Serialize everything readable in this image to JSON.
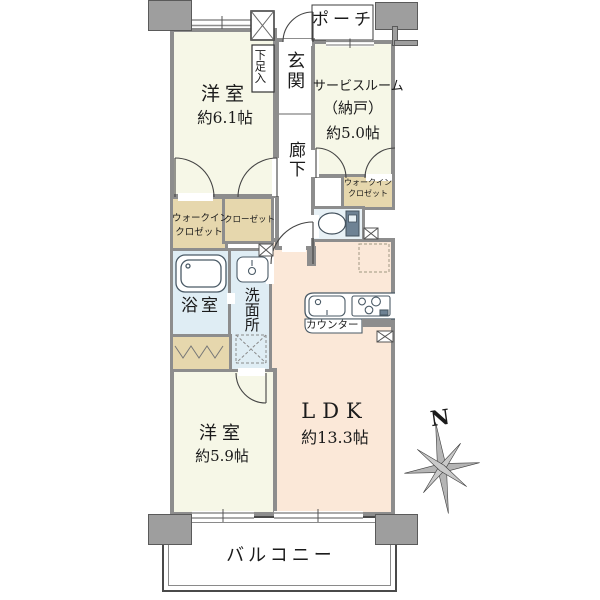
{
  "plan": {
    "rooms": {
      "porch": "ポーチ",
      "entrance": "玄関",
      "shoe_cabinet": "下足入",
      "hallway": "廊下",
      "bedroom1": {
        "name": "洋室",
        "size": "約6.1帖"
      },
      "service_room": {
        "name": "サービスルーム",
        "sub": "（納戸）",
        "size": "約5.0帖"
      },
      "wic_right": {
        "line1": "ウォークイン",
        "line2": "クロゼット"
      },
      "wic_left": {
        "line1": "ウォークイン",
        "line2": "クロゼット"
      },
      "closet": "クローゼット",
      "bathroom": "浴室",
      "washroom": "洗面所",
      "counter": "カウンター",
      "ldk": {
        "name": "LDK",
        "size": "約13.3帖"
      },
      "bedroom2": {
        "name": "洋室",
        "size": "約5.9帖"
      },
      "balcony": "バルコニー"
    },
    "compass": {
      "north_label": "N"
    },
    "colors": {
      "room_cream": "#f6f7e7",
      "ldk_peach": "#fbe8d8",
      "water_blue": "#dfedf4",
      "closet_tan": "#e6d7ad",
      "wall_gray": "#8d8d8d"
    }
  }
}
